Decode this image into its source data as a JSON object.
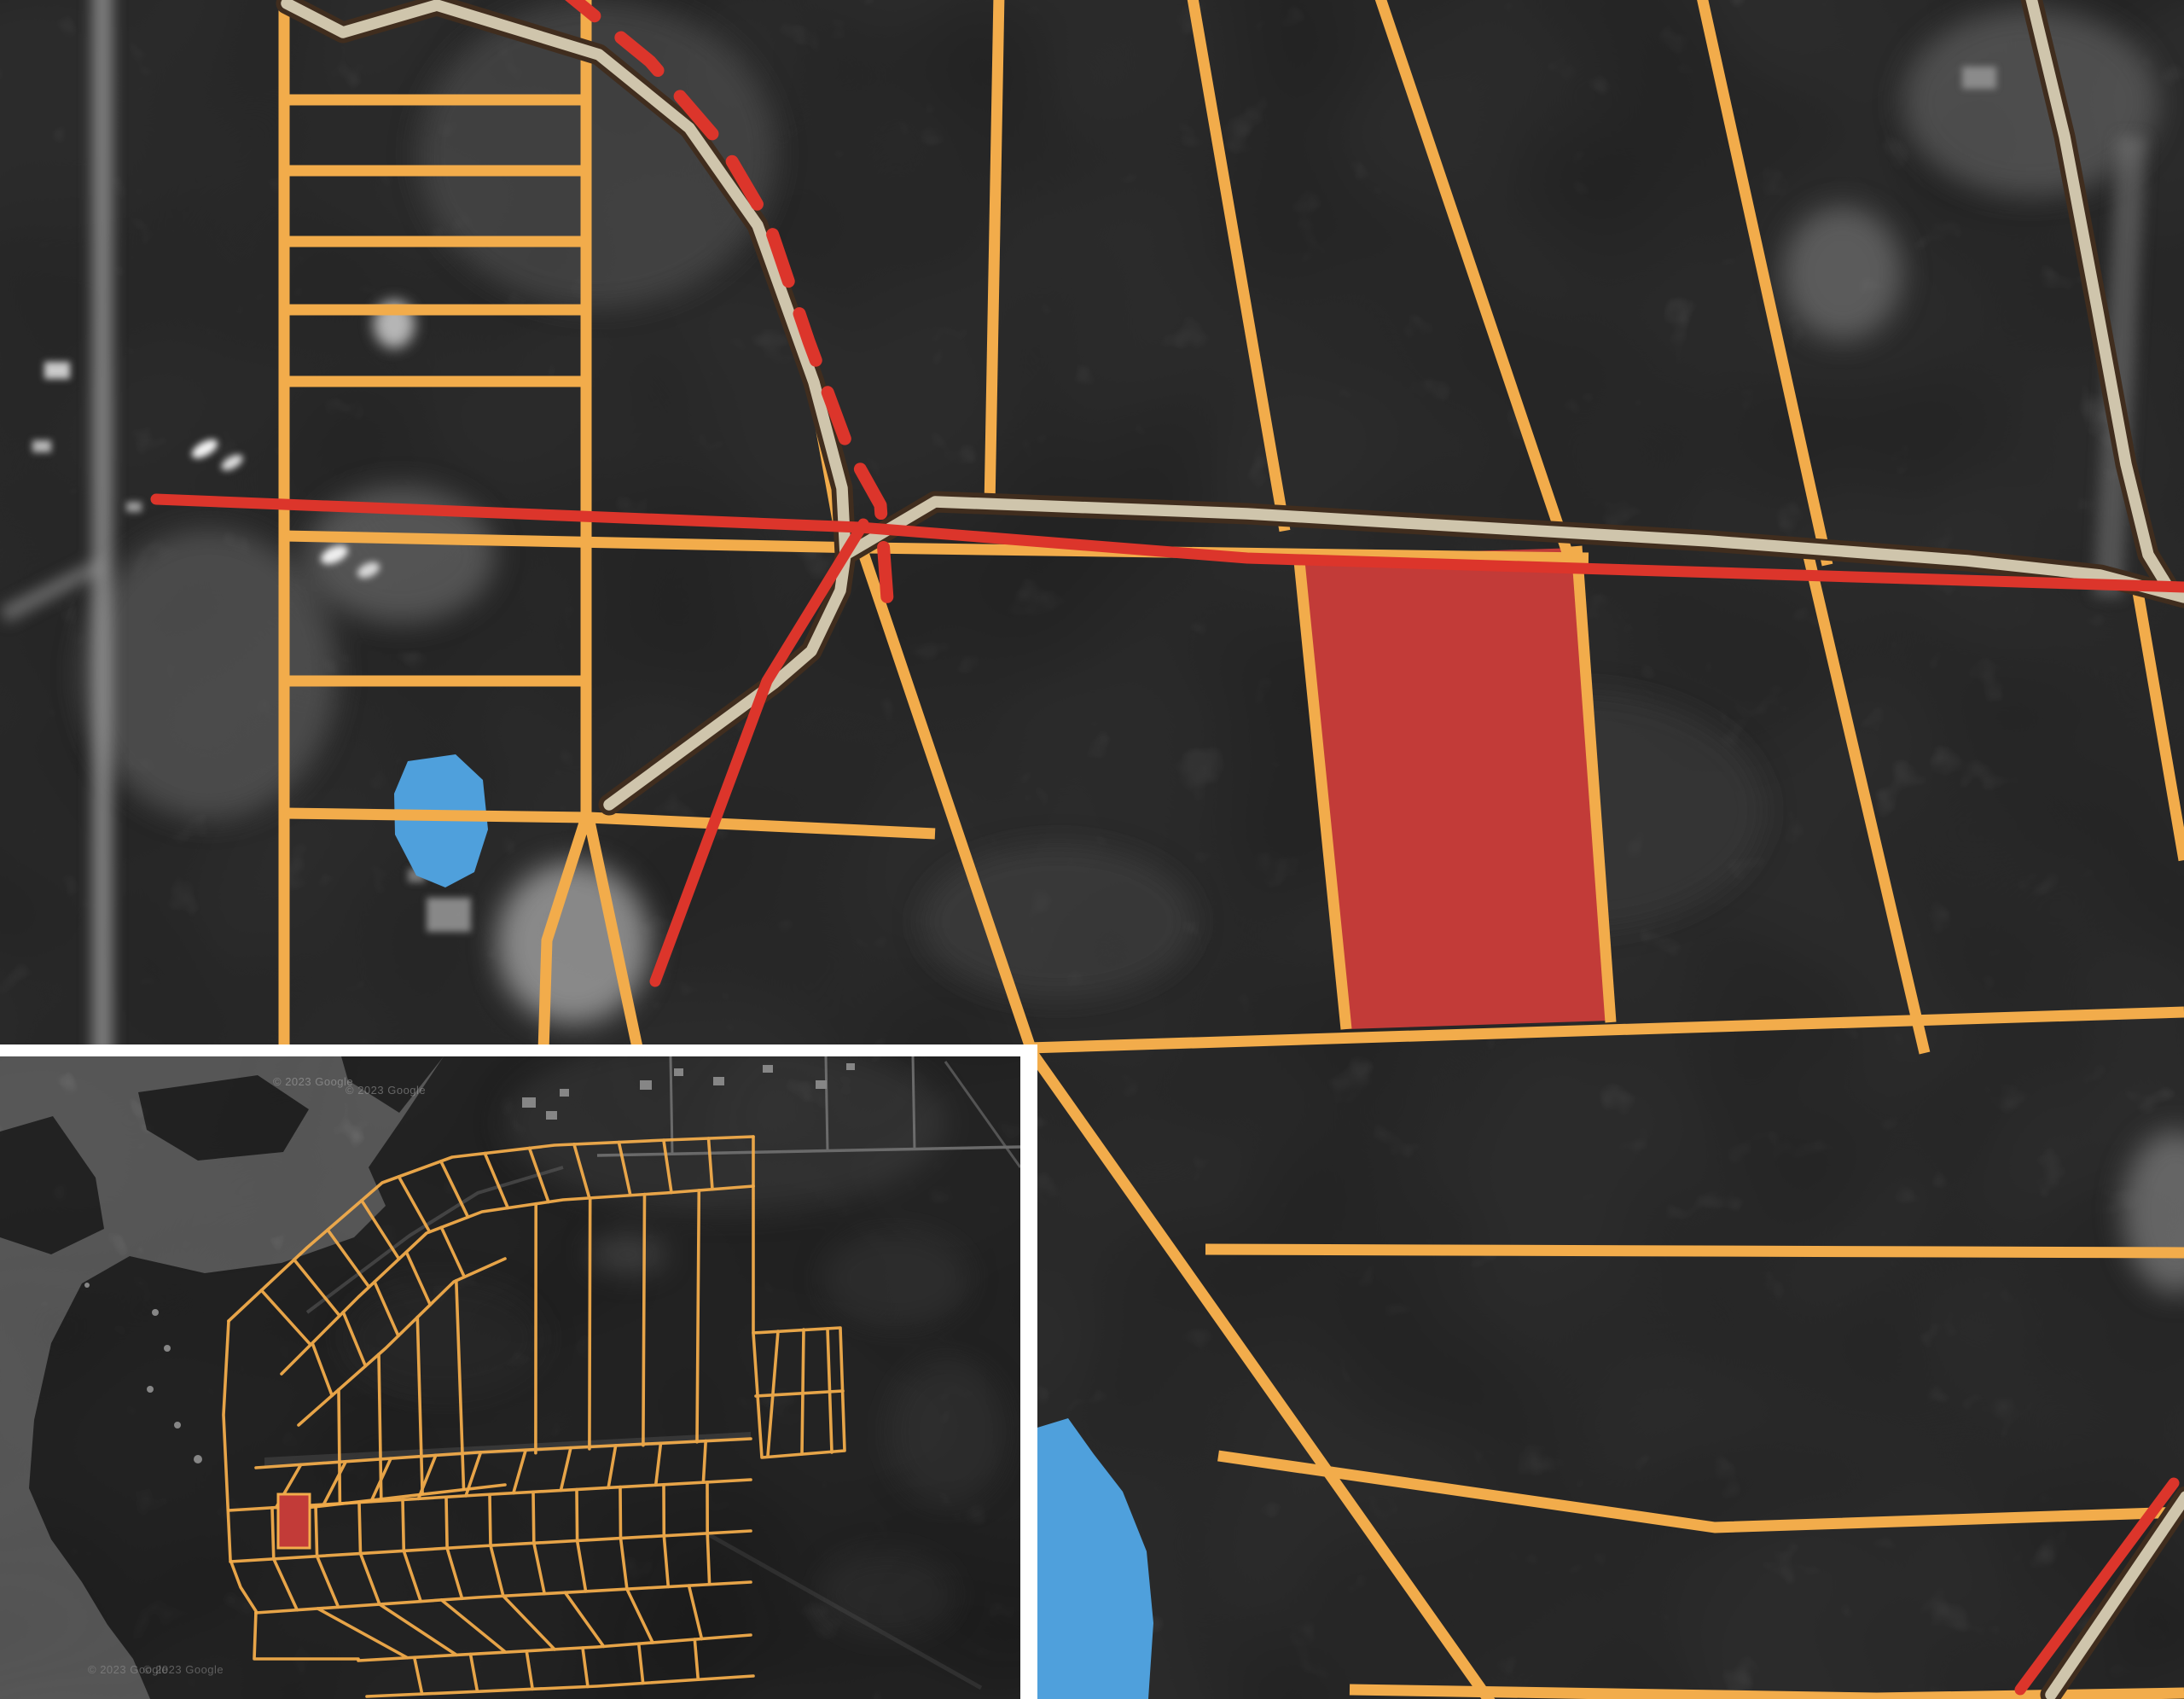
{
  "map": {
    "view": "satellite-parcel-overlay",
    "colors": {
      "aerial_base": "#303030",
      "parcel_line": "#F2AC4B",
      "road_casing": "#402D1E",
      "road_fill": "#CFC5AC",
      "red_line": "#DC352B",
      "selected_parcel": "#C23B38",
      "water": "#4FA0DC",
      "inset_frame": "#FFFFFF",
      "inset_land": "#282828",
      "inset_water": "#8B8B8B"
    },
    "inset": {
      "watermark": "© 2023 Google"
    }
  }
}
